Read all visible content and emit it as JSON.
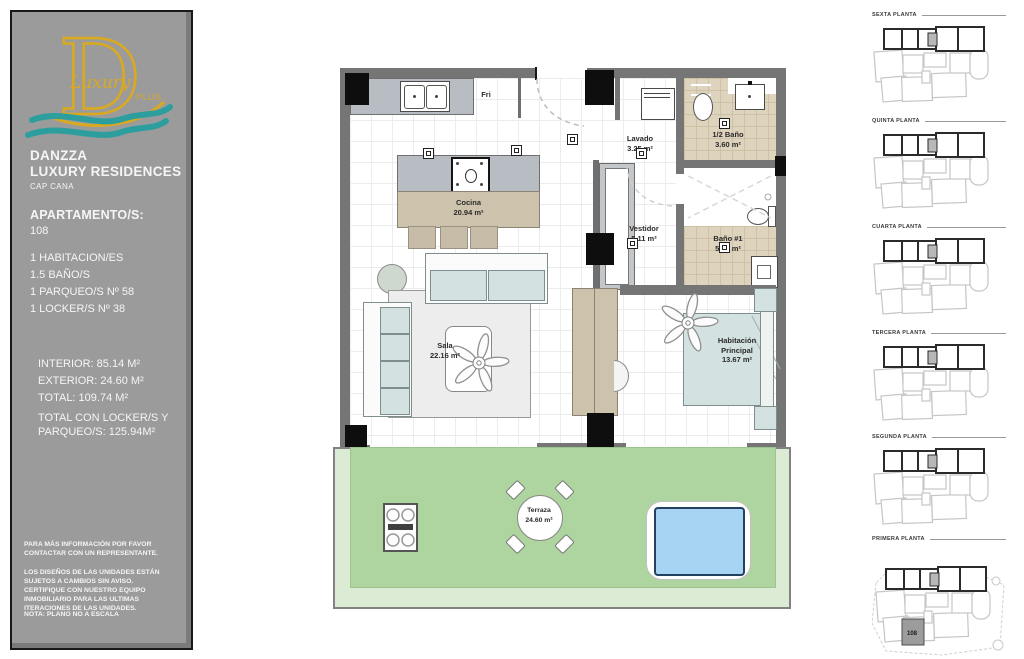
{
  "sidebar": {
    "logo": {
      "monogram": "D",
      "word": "Luxury",
      "plus": "PLUS"
    },
    "brand": {
      "line1": "DANZZA",
      "line2": "LUXURY RESIDENCES",
      "location": "CAP CANA"
    },
    "apartment": {
      "label": "APARTAMENTO/S:",
      "number": "108"
    },
    "features": [
      "1 HABITACION/ES",
      "1.5 BAÑO/S",
      "1 PARQUEO/S Nº 58",
      "1 LOCKER/S Nº 38"
    ],
    "areas": {
      "interior": "INTERIOR: 85.14 M²",
      "exterior": "EXTERIOR: 24.60 M²",
      "total": "TOTAL: 109.74 M²",
      "total_locker_line1": "TOTAL CON LOCKER/S Y",
      "total_locker_line2": "PARQUEO/S: 125.94M²"
    },
    "legal": {
      "contact": "PARA MÁS INFORMACIÓN POR FAVOR CONTACTAR CON UN REPRESENTANTE.",
      "disclaimer": "LOS DISEÑOS DE LAS UNIDADES ESTÁN SUJETOS A CAMBIOS SIN AVISO. CERTIFIQUE CON NUESTRO EQUIPO INMOBILIARIO PARA LAS ULTIMAS ITERACIONES DE LAS UNIDADES.",
      "note": "NOTA: PLANO NO A ESCALA"
    }
  },
  "floorplan": {
    "fridge_label": "Fri",
    "rooms": {
      "cocina": {
        "name": "Cocina",
        "area": "20.94 m²"
      },
      "lavado": {
        "name": "Lavado",
        "area": "3.25 m²"
      },
      "medio_bano": {
        "name": "1/2 Baño",
        "area": "3.60 m²"
      },
      "vestidor": {
        "name": "Vestidor",
        "area": "5.11 m²"
      },
      "bano1": {
        "name": "Baño #1",
        "area": "5.47 m²"
      },
      "sala": {
        "name": "Sala",
        "area": "22.16 m²"
      },
      "habitacion": {
        "name": "Habitación",
        "name2": "Principal",
        "area": "13.67 m²"
      },
      "terraza": {
        "name": "Terraza",
        "area": "24.60 m²"
      }
    }
  },
  "floor_levels": [
    {
      "label": "SEXTA PLANTA"
    },
    {
      "label": "QUINTA PLANTA"
    },
    {
      "label": "CUARTA PLANTA"
    },
    {
      "label": "TERCERA PLANTA"
    },
    {
      "label": "SEGUNDA PLANTA"
    },
    {
      "label": "PRIMERA PLANTA",
      "unit_label": "108"
    }
  ],
  "colors": {
    "sidebar_gray": "#9b9b9b",
    "logo_gold": "#d9a920",
    "logo_teal": "#2d9e9e",
    "wall_gray": "#757575",
    "tile_beige": "#ded3bd",
    "counter_gray": "#b7bdc2",
    "wood_tan": "#cdc3ad",
    "furniture_blue": "#d3e1e0",
    "terrace_green": "#aed49f",
    "terrace_light_green": "#dcebd3",
    "pool_blue": "#a6d4f2"
  }
}
